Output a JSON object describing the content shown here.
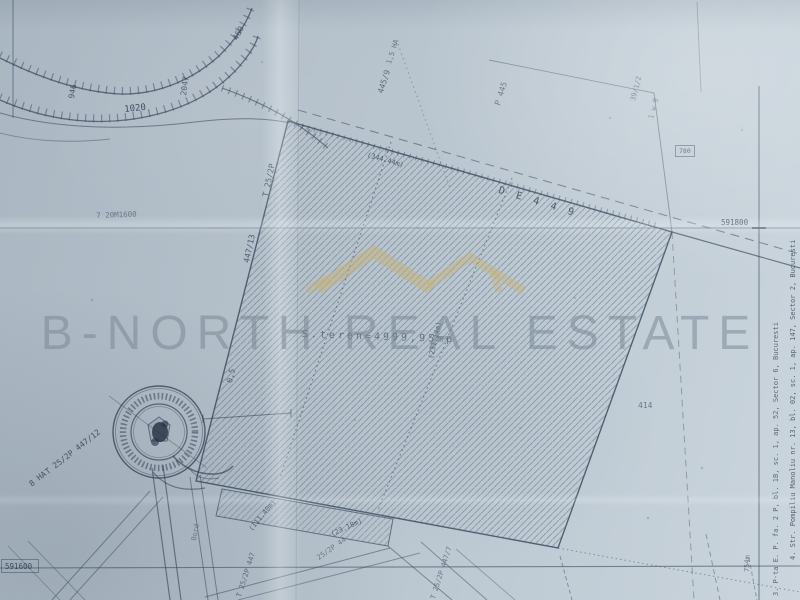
{
  "watermark": {
    "brand": "B-NORTH REAL ESTATE",
    "subtitle_dots": "· · · · · · · · · · · · ·",
    "logo_color": "#c6b277",
    "text_color": "#748492"
  },
  "palette": {
    "paper": "#b8c4ce",
    "ink": "#3c4c60",
    "hatch": "#5a6b7e",
    "stamp_ink": "#2a3647"
  },
  "grid": {
    "north_line_upper": "591800",
    "north_line_lower": "591600"
  },
  "map": {
    "labels": [
      {
        "name": "contour-label-946",
        "t": "946",
        "x": 68,
        "y": 98,
        "r": -80,
        "s": 8,
        "o": 0.7
      },
      {
        "name": "contour-label-1020",
        "t": "1020",
        "x": 124,
        "y": 106,
        "r": -6,
        "s": 9,
        "o": 0.8
      },
      {
        "name": "contour-label-2047",
        "t": "2047",
        "x": 180,
        "y": 95,
        "r": -82,
        "s": 8,
        "o": 0.65
      },
      {
        "name": "contour-label-460",
        "t": "460",
        "x": 232,
        "y": 38,
        "r": -62,
        "s": 8,
        "o": 0.7
      },
      {
        "name": "note-1600",
        "t": "7 20M1600",
        "x": 96,
        "y": 212,
        "r": -2,
        "s": 7.5,
        "o": 0.5
      },
      {
        "name": "parcel-edge-label-t252p",
        "t": "T 25/2P",
        "x": 262,
        "y": 196,
        "r": -78,
        "s": 8,
        "o": 0.7
      },
      {
        "name": "parcel-edge-label-44713",
        "t": "447/13",
        "x": 243,
        "y": 262,
        "r": -78,
        "s": 8,
        "o": 0.7
      },
      {
        "name": "area-label-15ha",
        "t": "1,5 HA",
        "x": 386,
        "y": 63,
        "r": -72,
        "s": 7,
        "o": 0.55
      },
      {
        "name": "parcel-label-445-9",
        "t": "445/9",
        "x": 377,
        "y": 92,
        "r": -72,
        "s": 8,
        "o": 0.6
      },
      {
        "name": "parcel-label-p445",
        "t": "P 445",
        "x": 494,
        "y": 104,
        "r": -72,
        "s": 8,
        "o": 0.55
      },
      {
        "name": "note-39-1-2",
        "t": "39/1/2",
        "x": 630,
        "y": 100,
        "r": -75,
        "s": 7,
        "o": 0.5
      },
      {
        "name": "note-1w9",
        "t": "1 w 9",
        "x": 648,
        "y": 118,
        "r": -75,
        "s": 7,
        "o": 0.45
      },
      {
        "name": "dim-344-44m",
        "t": "(344.44m)",
        "x": 368,
        "y": 152,
        "r": 16,
        "s": 7,
        "o": 0.7
      },
      {
        "name": "road-label-de449",
        "t": "D E 4 4 9",
        "x": 500,
        "y": 186,
        "r": 17,
        "s": 10,
        "o": 0.75,
        "ls": 3
      },
      {
        "name": "parcel-area-label",
        "t": "S.teren=4999,95mp",
        "x": 302,
        "y": 330,
        "r": 2,
        "s": 10,
        "o": 0.55,
        "ls": 3
      },
      {
        "name": "dim-231-14m",
        "t": "(231.14m)",
        "x": 428,
        "y": 358,
        "r": -77,
        "s": 7,
        "o": 0.65
      },
      {
        "name": "note-0-5",
        "t": "0,5",
        "x": 226,
        "y": 382,
        "r": -77,
        "s": 8,
        "o": 0.65
      },
      {
        "name": "parcel-label-447-12",
        "t": "T 25/2P 447/12",
        "x": 44,
        "y": 470,
        "r": -38,
        "s": 8,
        "o": 0.75
      },
      {
        "name": "area-label-8ha",
        "t": "8 HA",
        "x": 28,
        "y": 482,
        "r": -38,
        "s": 8,
        "o": 0.75
      },
      {
        "name": "dim-111-40m",
        "t": "(111.40m)",
        "x": 248,
        "y": 528,
        "r": -50,
        "s": 7,
        "o": 0.65
      },
      {
        "name": "dim-23-18m",
        "t": "(23.18m)",
        "x": 330,
        "y": 532,
        "r": -25,
        "s": 7,
        "o": 0.65
      },
      {
        "name": "bottom-parcel-label",
        "t": "T 25/2P 447",
        "x": 236,
        "y": 596,
        "r": -72,
        "s": 7,
        "o": 0.6
      },
      {
        "name": "bottom-parcel-label",
        "t": "25/2P 44",
        "x": 316,
        "y": 556,
        "r": -35,
        "s": 7,
        "o": 0.5
      },
      {
        "name": "bottom-parcel-label",
        "t": "T 25/2P 447/7",
        "x": 430,
        "y": 598,
        "r": -72,
        "s": 7,
        "o": 0.55
      },
      {
        "name": "note-414",
        "t": "414",
        "x": 638,
        "y": 402,
        "r": 0,
        "s": 8,
        "o": 0.55
      },
      {
        "name": "dim-754m",
        "t": "754m",
        "x": 744,
        "y": 572,
        "r": -88,
        "s": 7,
        "o": 0.55
      },
      {
        "name": "note-780",
        "t": "780",
        "x": 679,
        "y": 148,
        "r": 0,
        "s": 6.5,
        "o": 0.65
      },
      {
        "name": "road-label-bord",
        "t": "Bord",
        "x": 191,
        "y": 540,
        "r": -80,
        "s": 7,
        "o": 0.45
      },
      {
        "name": "grid-label-591800",
        "t": "591800",
        "x": 721,
        "y": 219,
        "r": 0,
        "s": 7.5,
        "o": 0.8
      },
      {
        "name": "grid-label-591600",
        "t": "591600",
        "x": 5,
        "y": 563,
        "r": 0,
        "s": 7.5,
        "o": 0.8
      },
      {
        "name": "address-line-1",
        "t": "4. Str. Pompiliu Manoliu nr. 13, bl. 02, sc. 1, ap. 147, Sector 2, Bucuresti",
        "x": 790,
        "y": 560,
        "r": -90,
        "s": 7,
        "o": 0.7
      },
      {
        "name": "address-line-2",
        "t": "3. P-ta E. P. fa. 2 P, bl. 1B, sc. 1, ap. 52, Sector 6, Bucuresti",
        "x": 773,
        "y": 596,
        "r": -90,
        "s": 7,
        "o": 0.65
      }
    ]
  }
}
